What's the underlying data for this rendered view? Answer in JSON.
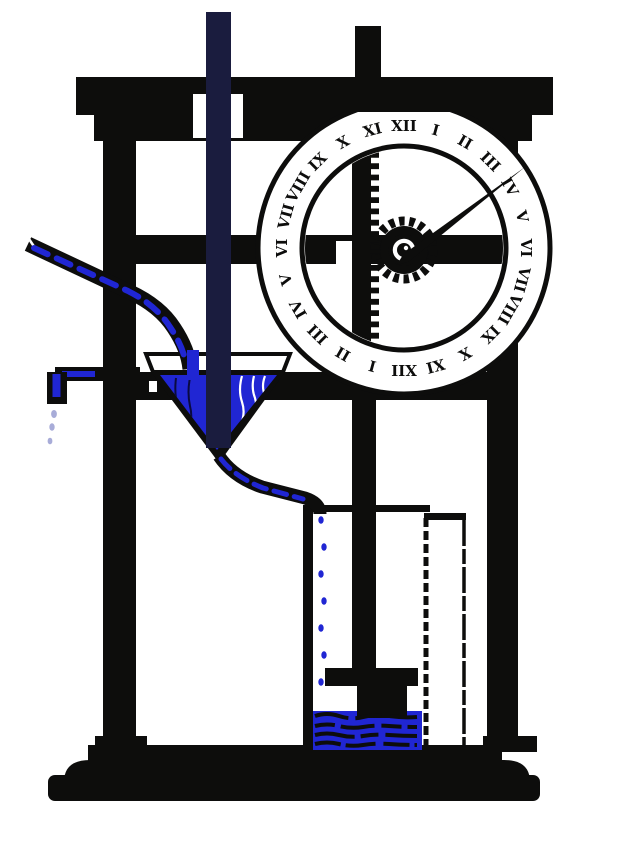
{
  "scene": {
    "title": "water-clock engraving",
    "description": "Clepsydra: water drips through a funnel into a cylinder; a float on a toothed rack turns a 24-hour dial"
  },
  "dial": {
    "numerals": [
      "XII",
      "I",
      "II",
      "III",
      "IV",
      "V",
      "VI",
      "VII",
      "VIII",
      "IX",
      "X",
      "XI",
      "XII",
      "I",
      "II",
      "III",
      "IV",
      "V",
      "VI",
      "VII",
      "VIII",
      "IX",
      "X",
      "XI"
    ],
    "hand_points_toward": "III",
    "style": "roman-numeral 24-hour ring"
  },
  "drips": {
    "cylinder_drops": 7,
    "spout_drops": 3
  },
  "icons": {
    "gear": "pinion-gear-icon",
    "rack": "toothed-rack-icon",
    "funnel": "funnel-icon",
    "hand": "clock-hand-icon"
  },
  "colors": {
    "ink": "#0d0d0c",
    "water_blue": "#2026d3",
    "pale_drip": "#a8acd8",
    "frame_tint": "#1a1c3e",
    "background": "#ffffff"
  }
}
